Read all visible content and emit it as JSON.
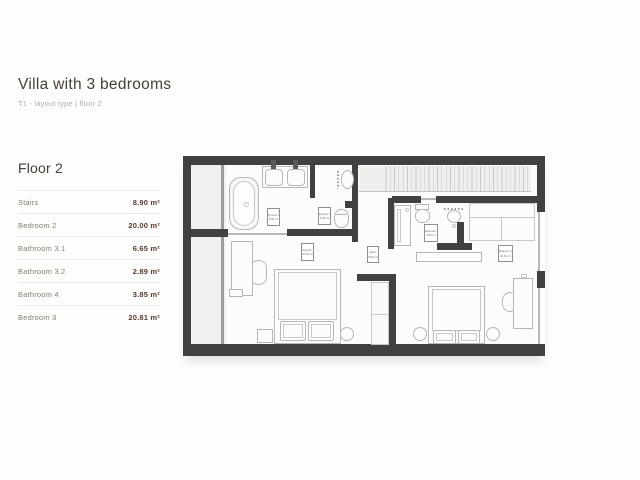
{
  "page": {
    "title": "Villa with 3 bedrooms",
    "subtitle": "T1 - layout type | floor 2"
  },
  "floor_panel": {
    "heading": "Floor 2",
    "rows": [
      {
        "label": "Stairs",
        "value": "8.90 m²"
      },
      {
        "label": "Bedroom 2",
        "value": "20.00 m²"
      },
      {
        "label": "Bathroom 3.1",
        "value": "6.65 m²"
      },
      {
        "label": "Bathroom 3.2",
        "value": "2.89 m²"
      },
      {
        "label": "Bathroom 4",
        "value": "3.85 m²"
      },
      {
        "label": "Bedroom 3",
        "value": "20.81 m²"
      }
    ]
  },
  "plan": {
    "colors": {
      "wall": "#414141",
      "furniture_line": "#b7b7b7",
      "light_fill": "#f1f1f0",
      "room_fill": "#fcfcfc"
    },
    "labels": [
      {
        "room": "Bathroom 3.1",
        "area": "6.65 m²"
      },
      {
        "room": "Bathroom 3.2",
        "area": "2.89 m²"
      },
      {
        "room": "Bedroom 2",
        "area": "20.00 m²"
      },
      {
        "room": "Stairs",
        "area": "8.90 m²"
      },
      {
        "room": "Bathroom 4",
        "area": "3.85 m²"
      },
      {
        "room": "Bedroom 3",
        "area": "20.81 m²"
      }
    ]
  }
}
